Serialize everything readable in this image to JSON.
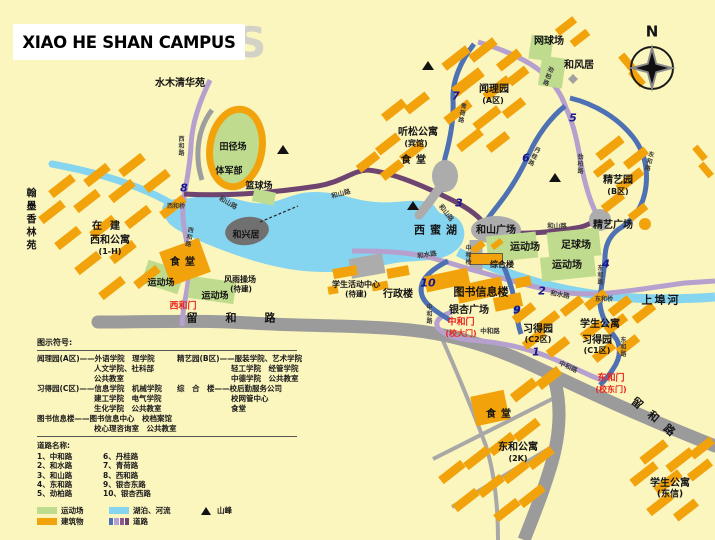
{
  "title": {
    "text": "XIAO HE SHAN CAMPUS",
    "watermark": "S"
  },
  "compass": {
    "label": "N"
  },
  "colors": {
    "background": "#FBF5BE",
    "building": "#F2A30C",
    "field": "#BFDC8E",
    "water": "#85D4F0",
    "road_gray": "#9B9B9B",
    "road_purple": "#6E4470",
    "road_lavender": "#B5A0CE",
    "road_blue": "#4E71B4",
    "plaza_gray": "#ACACAC",
    "island_gray": "#707070",
    "number_navy": "#16168E",
    "gate_red": "#E8251F"
  },
  "map_labels": [
    {
      "n": "label-shuimuqinghuayuan",
      "t": "水木清华苑",
      "x": 180,
      "y": 84,
      "fs": 10
    },
    {
      "n": "label-tianjingchang",
      "t": "田径场",
      "x": 233,
      "y": 148,
      "fs": 9
    },
    {
      "n": "label-tijunbu",
      "t": "体军部",
      "x": 229,
      "y": 172,
      "fs": 9
    },
    {
      "n": "label-lanqiuchang",
      "t": "篮球场",
      "x": 259,
      "y": 187,
      "fs": 9
    },
    {
      "n": "label-wangqiuchang",
      "t": "网球场",
      "x": 549,
      "y": 42,
      "fs": 10
    },
    {
      "n": "label-hefengju",
      "t": "和风居",
      "x": 579,
      "y": 66,
      "fs": 10
    },
    {
      "n": "label-wenliyuan",
      "t": "闻理园",
      "x": 494,
      "y": 90,
      "fs": 10
    },
    {
      "n": "label-wenliyuan-zone",
      "t": "(A区)",
      "x": 493,
      "y": 101,
      "fs": 8
    },
    {
      "n": "label-tingsonggongyu",
      "t": "听松公寓",
      "x": 418,
      "y": 133,
      "fs": 10
    },
    {
      "n": "label-tingsonggongyu-sub",
      "t": "(宾馆)",
      "x": 416,
      "y": 144,
      "fs": 8
    },
    {
      "n": "label-shitang-north",
      "t": "食堂",
      "x": 416,
      "y": 161,
      "fs": 10,
      "ls": 5
    },
    {
      "n": "label-jingyiyuan",
      "t": "精艺园",
      "x": 618,
      "y": 181,
      "fs": 10
    },
    {
      "n": "label-jingyiyuan-zone",
      "t": "(B区)",
      "x": 618,
      "y": 192,
      "fs": 8
    },
    {
      "n": "label-jingyi-guangchang",
      "t": "精艺广场",
      "x": 613,
      "y": 226,
      "fs": 10
    },
    {
      "n": "label-zuqiuchang",
      "t": "足球场",
      "x": 576,
      "y": 246,
      "fs": 10
    },
    {
      "n": "label-yundongchang-e1",
      "t": "运动场",
      "x": 525,
      "y": 248,
      "fs": 10
    },
    {
      "n": "label-yundongchang-e2",
      "t": "运动场",
      "x": 567,
      "y": 266,
      "fs": 10
    },
    {
      "n": "label-heshan-guangchang",
      "t": "和山广场",
      "x": 496,
      "y": 231,
      "fs": 10
    },
    {
      "n": "label-zonghelou",
      "t": "综合楼",
      "x": 502,
      "y": 265,
      "fs": 8
    },
    {
      "n": "label-tushuxinxilou",
      "t": "图书信息楼",
      "x": 481,
      "y": 292,
      "fs": 11
    },
    {
      "n": "label-yinxing-guangchang",
      "t": "银杏广场",
      "x": 469,
      "y": 311,
      "fs": 10
    },
    {
      "n": "label-xingzhenglou",
      "t": "行政楼",
      "x": 398,
      "y": 295,
      "fs": 10
    },
    {
      "n": "label-xuesheng-huodong-zhongxin",
      "t": "学生活动中心",
      "x": 356,
      "y": 285,
      "fs": 8
    },
    {
      "n": "label-xuesheng-huodong-sub",
      "t": "(待建)",
      "x": 356,
      "y": 294,
      "fs": 7.5
    },
    {
      "n": "label-fengyucaochang",
      "t": "风雨操场",
      "x": 240,
      "y": 280,
      "fs": 8
    },
    {
      "n": "label-fengyucaochang-sub",
      "t": "(待建)",
      "x": 241,
      "y": 289,
      "fs": 7.5
    },
    {
      "n": "label-yundongchang-w1",
      "t": "运动场",
      "x": 161,
      "y": 284,
      "fs": 9
    },
    {
      "n": "label-yundongchang-w2",
      "t": "运动场",
      "x": 215,
      "y": 297,
      "fs": 9
    },
    {
      "n": "label-shitang-west",
      "t": "食堂",
      "x": 185,
      "y": 263,
      "fs": 10,
      "ls": 5
    },
    {
      "n": "label-zaijian",
      "t": "在建",
      "x": 110,
      "y": 227,
      "fs": 10,
      "ls": 8
    },
    {
      "n": "label-xihegongyu",
      "t": "西和公寓",
      "x": 110,
      "y": 241,
      "fs": 10
    },
    {
      "n": "label-xihegongyu-sub",
      "t": "(1-H)",
      "x": 110,
      "y": 252,
      "fs": 8
    },
    {
      "n": "label-hanmoxianglinyuan",
      "t": "翰墨香林苑",
      "x": 29,
      "y": 220,
      "fs": 10,
      "v": 1,
      "ls": 3
    },
    {
      "n": "label-hexingju",
      "t": "和兴居",
      "x": 246,
      "y": 236,
      "fs": 9
    },
    {
      "n": "label-ximihu",
      "t": "西蜜湖",
      "x": 438,
      "y": 230,
      "fs": 11,
      "ls": 5
    },
    {
      "n": "label-shangbuhe",
      "t": "上埠河",
      "x": 661,
      "y": 300,
      "fs": 11,
      "ls": 2
    },
    {
      "n": "label-xuesheng-gongyu-c",
      "t": "学生公寓",
      "x": 600,
      "y": 325,
      "fs": 10
    },
    {
      "n": "label-xideyuan-c2",
      "t": "习得园",
      "x": 538,
      "y": 330,
      "fs": 10
    },
    {
      "n": "label-xideyuan-c2-zone",
      "t": "(C2区)",
      "x": 538,
      "y": 340,
      "fs": 8
    },
    {
      "n": "label-xideyuan-c1",
      "t": "习得园",
      "x": 597,
      "y": 341,
      "fs": 10
    },
    {
      "n": "label-xideyuan-c1-zone",
      "t": "(C1区)",
      "x": 597,
      "y": 351,
      "fs": 8
    },
    {
      "n": "label-xuesheng-gongyu-dongxin",
      "t": "学生公寓",
      "x": 670,
      "y": 484,
      "fs": 10
    },
    {
      "n": "label-xuesheng-gongyu-dongxin-sub",
      "t": "(东信)",
      "x": 670,
      "y": 495,
      "fs": 9
    },
    {
      "n": "label-donghegongyu",
      "t": "东和公寓",
      "x": 518,
      "y": 448,
      "fs": 10
    },
    {
      "n": "label-donghegongyu-sub",
      "t": "(2K)",
      "x": 518,
      "y": 459,
      "fs": 8
    },
    {
      "n": "label-shitang-se",
      "t": "食堂",
      "x": 501,
      "y": 415,
      "fs": 10,
      "ls": 5
    },
    {
      "n": "label-dongheqiao",
      "t": "东和桥",
      "x": 604,
      "y": 300,
      "fs": 6,
      "c": "road"
    },
    {
      "n": "label-xiheqiao",
      "t": "西和桥",
      "x": 176,
      "y": 207,
      "fs": 6,
      "c": "road"
    },
    {
      "n": "label-zhongheqiao",
      "t": "中和桥",
      "x": 467,
      "y": 255,
      "fs": 6,
      "v": 1,
      "c": "road"
    },
    {
      "n": "label-gate-xihemen",
      "t": "西和门",
      "x": 183,
      "y": 307,
      "fs": 9,
      "c": "red"
    },
    {
      "n": "label-gate-zhonghemen",
      "t": "中和门",
      "x": 461,
      "y": 323,
      "fs": 9,
      "c": "red"
    },
    {
      "n": "label-gate-zhonghemen-sub",
      "t": "(校大门)",
      "x": 461,
      "y": 334,
      "fs": 8,
      "c": "red"
    },
    {
      "n": "label-gate-donghemen",
      "t": "东和门",
      "x": 611,
      "y": 379,
      "fs": 9,
      "c": "red"
    },
    {
      "n": "label-gate-donghemen-sub",
      "t": "(校东门)",
      "x": 611,
      "y": 390,
      "fs": 8,
      "c": "red"
    },
    {
      "n": "road-label-xihelu-1",
      "t": "西和路",
      "x": 180,
      "y": 146,
      "fs": 6,
      "v": 1,
      "c": "road"
    },
    {
      "n": "road-label-xihelu-2",
      "t": "西和路",
      "x": 188,
      "y": 237,
      "fs": 6,
      "v": 1,
      "r": 10,
      "c": "road"
    },
    {
      "n": "road-label-heshanlu-1",
      "t": "和山路",
      "x": 228,
      "y": 203,
      "fs": 6.5,
      "r": 30,
      "c": "road"
    },
    {
      "n": "road-label-heshanlu-2",
      "t": "和山路",
      "x": 341,
      "y": 194,
      "fs": 6.5,
      "r": -15,
      "c": "road"
    },
    {
      "n": "road-label-heshanlu-3",
      "t": "和山路",
      "x": 446,
      "y": 213,
      "fs": 6.5,
      "r": 52,
      "c": "road"
    },
    {
      "n": "road-label-heshanlu-4",
      "t": "和山路",
      "x": 557,
      "y": 226,
      "fs": 6.5,
      "c": "road"
    },
    {
      "n": "road-label-heshuilu-1",
      "t": "和水路",
      "x": 427,
      "y": 255,
      "fs": 6.5,
      "r": -8,
      "c": "road"
    },
    {
      "n": "road-label-heshuilu-2",
      "t": "和水路",
      "x": 560,
      "y": 295,
      "fs": 6.5,
      "r": 10,
      "c": "road"
    },
    {
      "n": "road-label-zhonghelu-1",
      "t": "中和路",
      "x": 428,
      "y": 314,
      "fs": 6,
      "v": 1,
      "c": "road"
    },
    {
      "n": "road-label-zhonghelu-2",
      "t": "中和路",
      "x": 490,
      "y": 331,
      "fs": 6.5,
      "c": "road"
    },
    {
      "n": "road-label-zhonghelu-3",
      "t": "中和路",
      "x": 568,
      "y": 367,
      "fs": 6.5,
      "r": 25,
      "c": "road"
    },
    {
      "n": "road-label-jinbailu-1",
      "t": "劲柏路",
      "x": 547,
      "y": 76,
      "fs": 6,
      "v": 1,
      "r": 20,
      "c": "road"
    },
    {
      "n": "road-label-jinbailu-2",
      "t": "劲柏路",
      "x": 579,
      "y": 164,
      "fs": 6,
      "v": 1,
      "c": "road"
    },
    {
      "n": "road-label-qinghelu",
      "t": "青荷路",
      "x": 461,
      "y": 113,
      "fs": 6,
      "v": 1,
      "r": 10,
      "c": "road"
    },
    {
      "n": "road-label-danguilu",
      "t": "丹桂路",
      "x": 533,
      "y": 156,
      "fs": 6,
      "v": 1,
      "r": 25,
      "c": "road"
    },
    {
      "n": "road-label-donghelu-1",
      "t": "东和路",
      "x": 648,
      "y": 161,
      "fs": 6,
      "v": 1,
      "r": 15,
      "c": "road"
    },
    {
      "n": "road-label-donghelu-2",
      "t": "东和路",
      "x": 599,
      "y": 275,
      "fs": 6,
      "v": 1,
      "c": "road"
    },
    {
      "n": "road-label-donghelu-3",
      "t": "东和路",
      "x": 622,
      "y": 347,
      "fs": 6,
      "v": 1,
      "c": "road"
    },
    {
      "n": "road-label-liuhelu-1",
      "t": "留和路",
      "x": 245,
      "y": 318,
      "fs": 11,
      "ls": 28
    },
    {
      "n": "road-label-liuhelu-2",
      "t": "留和路",
      "x": 657,
      "y": 420,
      "fs": 11,
      "ls": 10,
      "r": 40
    },
    {
      "n": "compass-n-label",
      "t": "N",
      "x": 652,
      "y": 32,
      "fs": 15
    }
  ],
  "road_numbers": [
    {
      "t": "1",
      "x": 536,
      "y": 352
    },
    {
      "t": "2",
      "x": 542,
      "y": 291
    },
    {
      "t": "3",
      "x": 459,
      "y": 203
    },
    {
      "t": "4",
      "x": 606,
      "y": 264
    },
    {
      "t": "5",
      "x": 573,
      "y": 118
    },
    {
      "t": "6",
      "x": 526,
      "y": 158
    },
    {
      "t": "7",
      "x": 456,
      "y": 96
    },
    {
      "t": "8",
      "x": 184,
      "y": 188
    },
    {
      "t": "9",
      "x": 517,
      "y": 310
    },
    {
      "t": "10",
      "x": 428,
      "y": 283
    }
  ],
  "legend": {
    "symbols_title": "图示符号:",
    "sections_left": [
      {
        "t": "闻理园(A区)——外语学院　理学院",
        "ind": 0
      },
      {
        "t": "人文学院、社科部",
        "ind": 1
      },
      {
        "t": "公共教室",
        "ind": 1
      },
      {
        "t": "习得园(C区)——信息学院　机械学院",
        "ind": 0
      },
      {
        "t": "建工学院　电气学院",
        "ind": 1
      },
      {
        "t": "生化学院　公共教室",
        "ind": 1
      },
      {
        "t": "图书信息楼——图书信息中心　校档案馆",
        "ind": 0
      },
      {
        "t": "校心理咨询室　公共教室",
        "ind": 1
      }
    ],
    "sections_right": [
      {
        "t": "精艺园(B区)——服装学院、艺术学院",
        "ind": 0
      },
      {
        "t": "轻工学院　经管学院",
        "ind": 1
      },
      {
        "t": "中德学院　公共教室",
        "ind": 1
      },
      {
        "t": "综　合　楼——校后勤服务公司",
        "ind": 0
      },
      {
        "t": "校网管中心",
        "ind": 1
      },
      {
        "t": "食堂",
        "ind": 1
      }
    ],
    "roads_title": "道路名称:",
    "road_names": [
      "1、中和路",
      "2、和水路",
      "3、和山路",
      "4、东和路",
      "5、劲柏路",
      "6、丹桂路",
      "7、青荷路",
      "8、西和路",
      "9、银杏东路",
      "10、银杏西路"
    ],
    "symbols": [
      {
        "label": "运动场"
      },
      {
        "label": "湖泊、河流"
      },
      {
        "label": "山峰"
      },
      {
        "label": "建筑物"
      },
      {
        "label": "道路"
      }
    ]
  }
}
